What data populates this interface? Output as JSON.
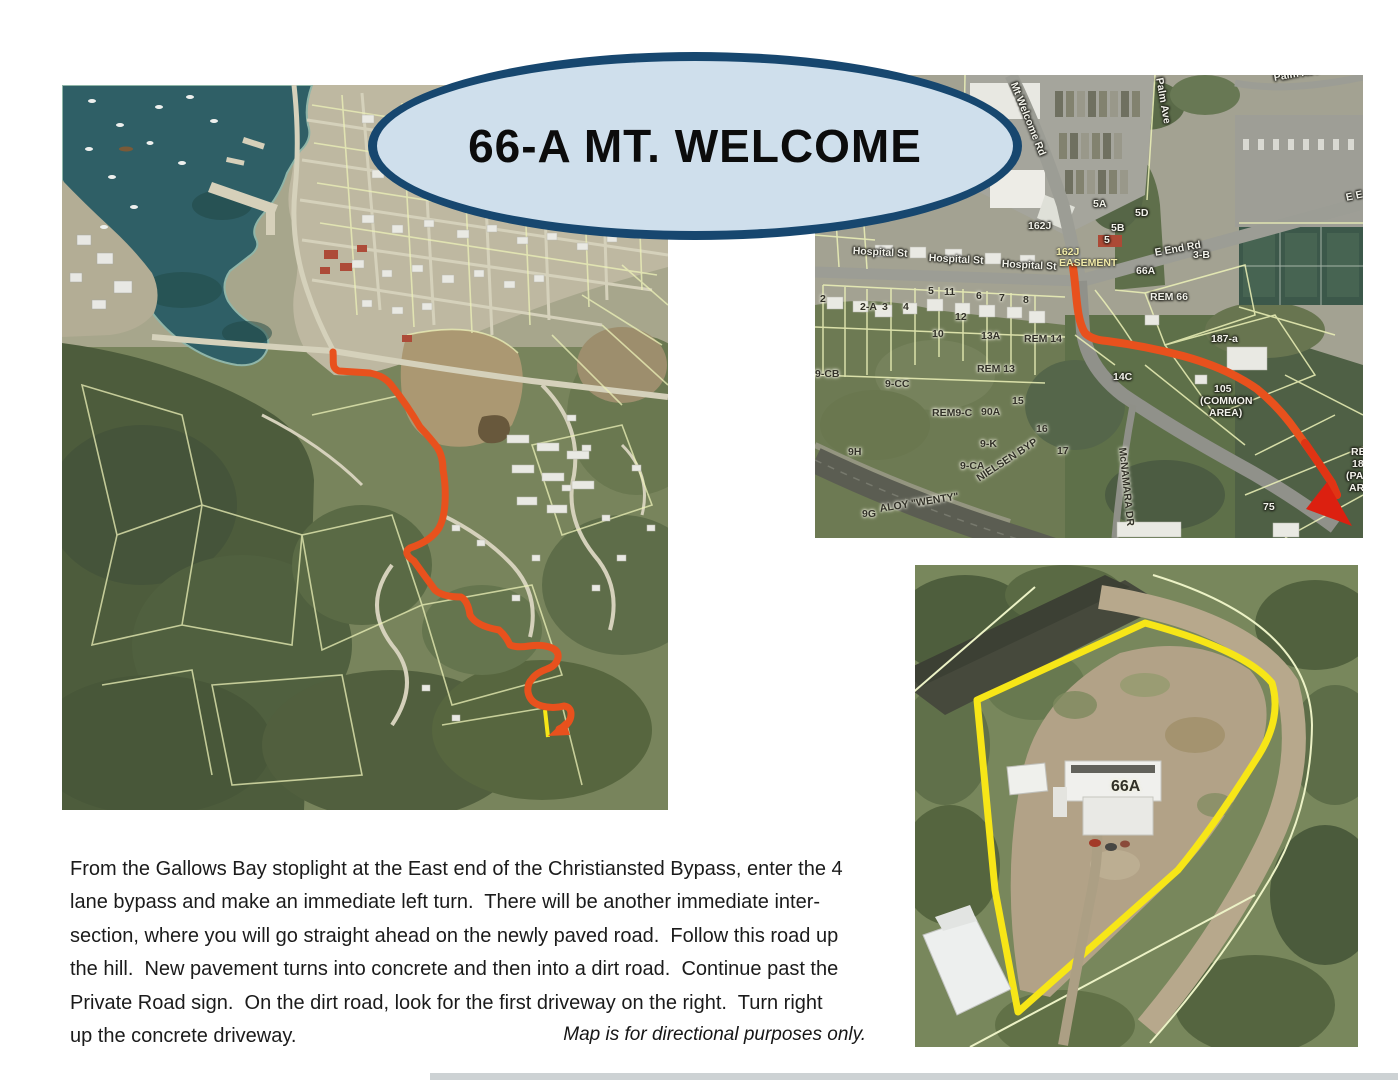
{
  "title": "66-A MT. WELCOME",
  "disclaimer": "Map is for directional purposes only.",
  "directions": {
    "lines": [
      "From the Gallows Bay stoplight at the East end of the Christiansted Bypass, enter the 4",
      "lane bypass and make an immediate left turn.  There will be another immediate inter-",
      "section, where you will go straight ahead on the newly paved road.  Follow this road up",
      "the hill.  New pavement turns into concrete and then into a dirt road.  Continue past the",
      "Private Road sign.  On the dirt road, look for the first driveway on the right.  Turn right",
      "up the concrete driveway."
    ]
  },
  "colors": {
    "route": "#e8511d",
    "arrow": "#dc2010",
    "highlight": "#f7e617",
    "oval_fill": "#cfdfec",
    "oval_border": "#17476f",
    "water": "#2f5f66",
    "parcel_line": "#edf2b8"
  },
  "maps": {
    "overview": {
      "labels": []
    },
    "detail": {
      "labels": [
        {
          "t": "Mt Welcome Rd",
          "x": 203,
          "y": 6,
          "r": 68,
          "c": "w"
        },
        {
          "t": "Palm Ave",
          "x": 349,
          "y": 2,
          "r": 80,
          "c": "w"
        },
        {
          "t": "Palm Ave",
          "x": 458,
          "y": -2,
          "r": -10,
          "c": "w"
        },
        {
          "t": "E E",
          "x": 530,
          "y": 118,
          "r": -12,
          "c": "w"
        },
        {
          "t": "5A",
          "x": 278,
          "y": 124,
          "r": 0,
          "c": "w"
        },
        {
          "t": "5D",
          "x": 320,
          "y": 133,
          "r": 0,
          "c": "w"
        },
        {
          "t": "5B",
          "x": 296,
          "y": 148,
          "r": 0,
          "c": "w"
        },
        {
          "t": "5",
          "x": 289,
          "y": 160,
          "r": 0,
          "c": "w"
        },
        {
          "t": "162J",
          "x": 213,
          "y": 146,
          "r": 0,
          "c": "w"
        },
        {
          "t": "162J",
          "x": 241,
          "y": 172,
          "r": 0,
          "c": "y"
        },
        {
          "t": "EASEMENT",
          "x": 244,
          "y": 183,
          "r": 0,
          "c": "y"
        },
        {
          "t": "Hospital St",
          "x": 38,
          "y": 171,
          "r": 3,
          "c": "w"
        },
        {
          "t": "Hospital St",
          "x": 114,
          "y": 178,
          "r": 3,
          "c": "w"
        },
        {
          "t": "Hospital St",
          "x": 187,
          "y": 184,
          "r": 3,
          "c": "w"
        },
        {
          "t": "E End Rd",
          "x": 339,
          "y": 173,
          "r": -10,
          "c": "w"
        },
        {
          "t": "3-B",
          "x": 378,
          "y": 175,
          "r": 0,
          "c": "w"
        },
        {
          "t": "66A",
          "x": 321,
          "y": 191,
          "r": 0,
          "c": "w"
        },
        {
          "t": "REM 66",
          "x": 335,
          "y": 217,
          "r": 0,
          "c": "w"
        },
        {
          "t": "2",
          "x": 5,
          "y": 219,
          "r": 0,
          "c": "d"
        },
        {
          "t": "2-A",
          "x": 45,
          "y": 227,
          "r": 0,
          "c": "d"
        },
        {
          "t": "3",
          "x": 67,
          "y": 227,
          "r": 0,
          "c": "d"
        },
        {
          "t": "4",
          "x": 88,
          "y": 227,
          "r": 0,
          "c": "d"
        },
        {
          "t": "5",
          "x": 113,
          "y": 211,
          "r": 0,
          "c": "d"
        },
        {
          "t": "11",
          "x": 129,
          "y": 212,
          "r": 0,
          "c": "d"
        },
        {
          "t": "6",
          "x": 161,
          "y": 216,
          "r": 0,
          "c": "d"
        },
        {
          "t": "7",
          "x": 184,
          "y": 218,
          "r": 0,
          "c": "d"
        },
        {
          "t": "8",
          "x": 208,
          "y": 220,
          "r": 0,
          "c": "d"
        },
        {
          "t": "12",
          "x": 140,
          "y": 237,
          "r": 0,
          "c": "d"
        },
        {
          "t": "10",
          "x": 117,
          "y": 254,
          "r": 0,
          "c": "d"
        },
        {
          "t": "13A",
          "x": 166,
          "y": 256,
          "r": 0,
          "c": "d"
        },
        {
          "t": "REM 14",
          "x": 209,
          "y": 259,
          "r": 0,
          "c": "d"
        },
        {
          "t": "REM 13",
          "x": 162,
          "y": 289,
          "r": 0,
          "c": "d"
        },
        {
          "t": "9-CB",
          "x": 0,
          "y": 294,
          "r": 0,
          "c": "d"
        },
        {
          "t": "9-CC",
          "x": 70,
          "y": 304,
          "r": 0,
          "c": "d"
        },
        {
          "t": "15",
          "x": 197,
          "y": 321,
          "r": 0,
          "c": "d"
        },
        {
          "t": "REM9-C",
          "x": 117,
          "y": 333,
          "r": 0,
          "c": "d"
        },
        {
          "t": "90A",
          "x": 166,
          "y": 332,
          "r": 0,
          "c": "d"
        },
        {
          "t": "16",
          "x": 221,
          "y": 349,
          "r": 0,
          "c": "d"
        },
        {
          "t": "9-K",
          "x": 165,
          "y": 364,
          "r": 0,
          "c": "d"
        },
        {
          "t": "17",
          "x": 242,
          "y": 371,
          "r": 0,
          "c": "d"
        },
        {
          "t": "9H",
          "x": 33,
          "y": 372,
          "r": 0,
          "c": "d"
        },
        {
          "t": "9-CA",
          "x": 145,
          "y": 386,
          "r": 0,
          "c": "d"
        },
        {
          "t": "14C",
          "x": 298,
          "y": 297,
          "r": 0,
          "c": "w"
        },
        {
          "t": "187-a",
          "x": 396,
          "y": 259,
          "r": 0,
          "c": "w"
        },
        {
          "t": "105",
          "x": 399,
          "y": 309,
          "r": 0,
          "c": "w"
        },
        {
          "t": "(COMMON",
          "x": 385,
          "y": 321,
          "r": 0,
          "c": "w"
        },
        {
          "t": "AREA)",
          "x": 394,
          "y": 333,
          "r": 0,
          "c": "w"
        },
        {
          "t": "McNAMARA DR",
          "x": 312,
          "y": 372,
          "r": 84,
          "c": "d"
        },
        {
          "t": "ALOY \"WENTY\"",
          "x": 64,
          "y": 429,
          "r": -9,
          "c": "d"
        },
        {
          "t": "NIELSEN BYP",
          "x": 160,
          "y": 400,
          "r": -33,
          "c": "d"
        },
        {
          "t": "9G",
          "x": 47,
          "y": 434,
          "r": 0,
          "c": "d"
        },
        {
          "t": "75",
          "x": 448,
          "y": 427,
          "r": 0,
          "c": "w"
        },
        {
          "t": "RE",
          "x": 536,
          "y": 372,
          "r": 0,
          "c": "w"
        },
        {
          "t": "18",
          "x": 537,
          "y": 384,
          "r": 0,
          "c": "w"
        },
        {
          "t": "(PA",
          "x": 531,
          "y": 396,
          "r": 0,
          "c": "w"
        },
        {
          "t": "AR",
          "x": 534,
          "y": 408,
          "r": 0,
          "c": "w"
        }
      ]
    },
    "closeup": {
      "labels": [
        {
          "t": "66A",
          "x": 196,
          "y": 216,
          "r": 0,
          "c": "d big"
        }
      ]
    }
  }
}
